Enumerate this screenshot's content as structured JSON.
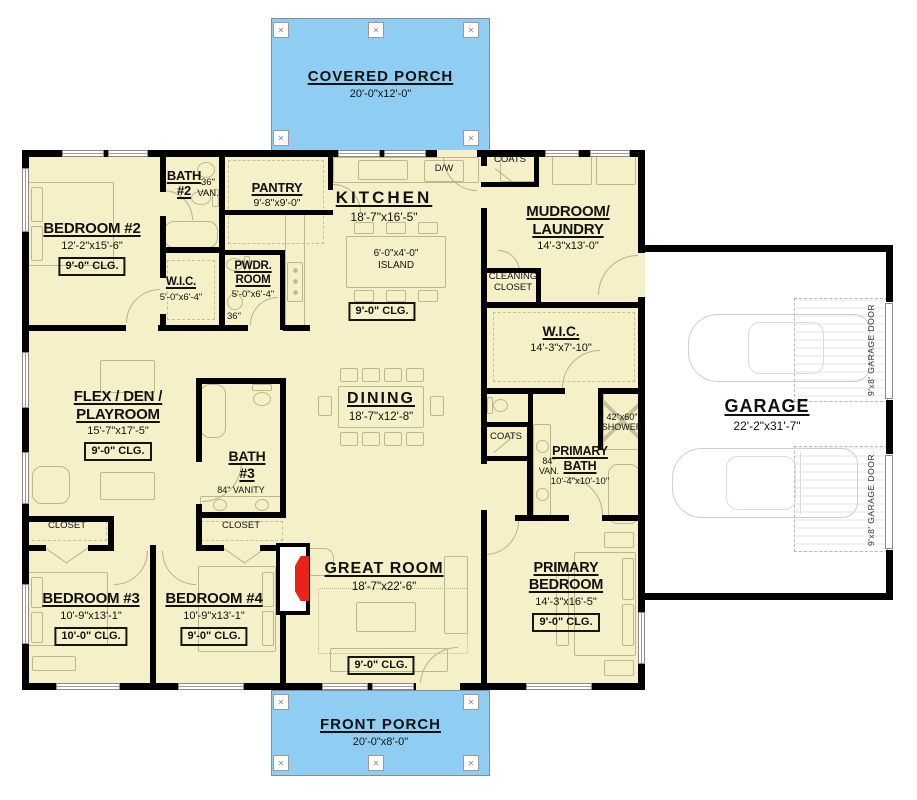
{
  "page": {
    "type": "house-floor-plan"
  },
  "colors": {
    "porch_blue": "#8FCEF2",
    "floor_tan": "#F6F0C8",
    "wall_black": "#000000",
    "fireplace_red": "#E8231A",
    "fixture_line": "#BFB78C"
  },
  "porches": {
    "covered": {
      "title": "COVERED PORCH",
      "dims": "20'-0\"x12'-0\""
    },
    "front": {
      "title": "FRONT PORCH",
      "dims": "20'-0\"x8'-0\""
    }
  },
  "garage": {
    "title": "GARAGE",
    "dims": "22'-2\"x31'-7\"",
    "door_label": "9'x8' GARAGE DOOR"
  },
  "rooms": {
    "bedroom2": {
      "title": "BEDROOM #2",
      "dims": "12'-2\"x15'-6\"",
      "clg": "9'-0\" CLG."
    },
    "bath2": {
      "title": "BATH #2"
    },
    "wic2": {
      "title": "W.I.C.",
      "dims": "5'-0\"x6'-4\""
    },
    "pwdr": {
      "title": "PWDR. ROOM",
      "dims": "5'-0\"x6'-4\""
    },
    "pantry": {
      "title": "PANTRY",
      "dims": "9'-8\"x9'-0\""
    },
    "kitchen": {
      "title": "KITCHEN",
      "dims": "18'-7\"x16'-5\"",
      "clg": "9'-0\" CLG."
    },
    "mudroom": {
      "title": "MUDROOM/ LAUNDRY",
      "dims": "14'-3\"x13'-0\""
    },
    "wic_primary": {
      "title": "W.I.C.",
      "dims": "14'-3\"x7'-10\""
    },
    "primary_bath": {
      "title": "PRIMARY BATH",
      "dims": "10'-4\"x10'-10\""
    },
    "flex": {
      "title": "FLEX / DEN / PLAYROOM",
      "dims": "15'-7\"x17'-5\"",
      "clg": "9'-0\" CLG."
    },
    "bath3": {
      "title": "BATH #3"
    },
    "dining": {
      "title": "DINING",
      "dims": "18'-7\"x12'-8\""
    },
    "great_room": {
      "title": "GREAT ROOM",
      "dims": "18'-7\"x22'-6\"",
      "clg": "9'-0\" CLG."
    },
    "bedroom3": {
      "title": "BEDROOM #3",
      "dims": "10'-9\"x13'-1\"",
      "clg": "10'-0\" CLG."
    },
    "bedroom4": {
      "title": "BEDROOM #4",
      "dims": "10'-9\"x13'-1\"",
      "clg": "9'-0\" CLG."
    },
    "primary_bedroom": {
      "title": "PRIMARY BEDROOM",
      "dims": "14'-3\"x16'-5\"",
      "clg": "9'-0\" CLG."
    }
  },
  "labels": {
    "dw": "D/W",
    "island_dims": "6'-0\"x4'-0\"",
    "island": "ISLAND",
    "van36": "36\" VAN.",
    "van84": "84\" VAN.",
    "vanity84": "84\" VANITY",
    "shower": "42\"x60\" SHOWER",
    "note36": "36\"",
    "coats": "COATS",
    "closet": "CLOSET",
    "cleaning_closet": "CLEANING CLOSET"
  }
}
